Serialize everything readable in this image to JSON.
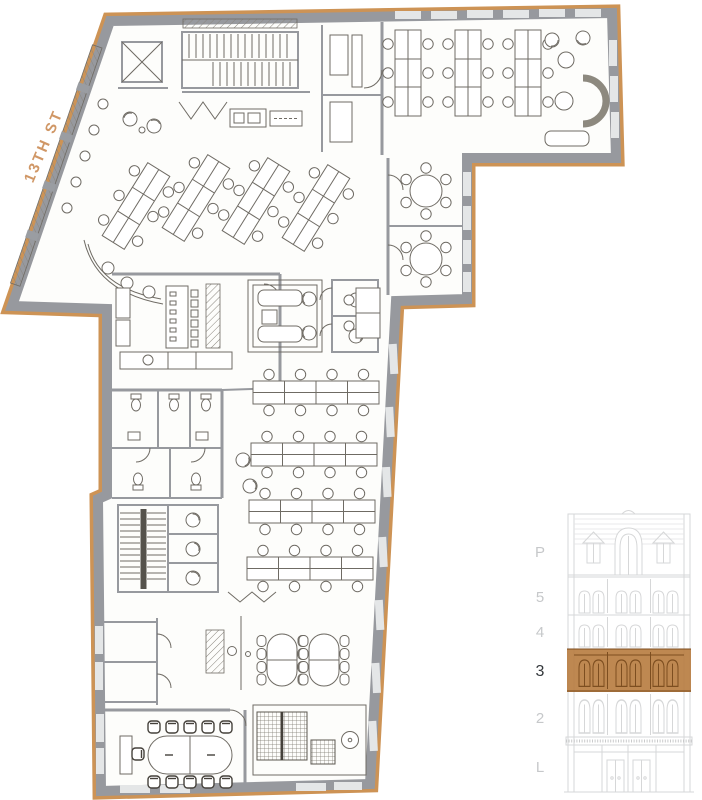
{
  "street_label": "13TH ST",
  "elevation": {
    "highlighted_floor": "3",
    "floors": [
      {
        "label": "P",
        "active": false
      },
      {
        "label": "5",
        "active": false
      },
      {
        "label": "4",
        "active": false
      },
      {
        "label": "3",
        "active": true
      },
      {
        "label": "2",
        "active": false
      },
      {
        "label": "L",
        "active": false
      }
    ]
  },
  "colors": {
    "background": "#ffffff",
    "outline_tan": "#cd9355",
    "street_text": "#c8854c",
    "wall_gray": "#97999e",
    "drawing_ink": "#6f6b64",
    "highlight_brown": "#b97e42",
    "highlight_line": "#7d4e20",
    "elevation_line": "#d6d7d8",
    "floor_label": "#c6c8ca",
    "floor_label_active": "#34383c"
  }
}
